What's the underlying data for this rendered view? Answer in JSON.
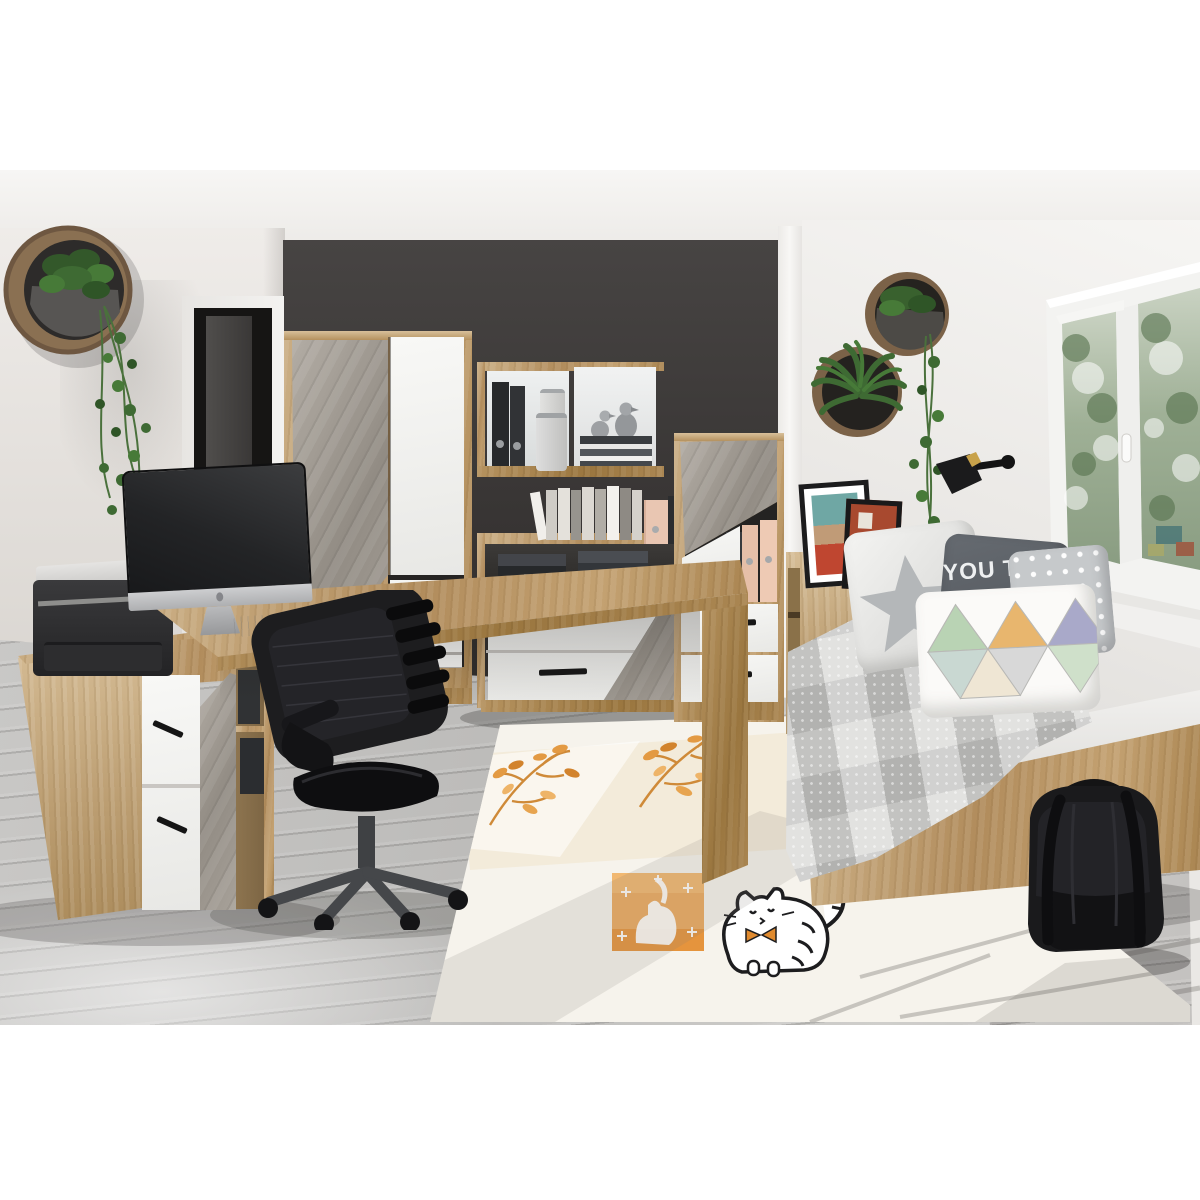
{
  "scene": {
    "title": "Teen room furniture set product photo",
    "pillow_quote": {
      "line1": "YOU T",
      "line2": "MOO",
      "line3": "O BACK"
    },
    "objects": [
      "round wall planter with trailing vine",
      "interior door",
      "wardrobe with concrete and white doors",
      "wall shelf with binders, canisters, books and silver figurines",
      "sideboard with storage boxes",
      "narrow cabinet with pink folders",
      "corner desk",
      "all-in-one computer",
      "keyboard",
      "mouse",
      "laser printer",
      "mesh office chair",
      "low cabinet with drawers and binder shelf",
      "daybed with patchwork quilt",
      "star pillow",
      "quote pillow",
      "polka-dot pillow",
      "triangle pillow",
      "headboard shelf with two picture frames",
      "two round wall planters",
      "black wall lamp",
      "white window with greenery outside",
      "black backpack",
      "kids rug with orange branches and cat print"
    ]
  },
  "palette": {
    "accent_wall": "#3b3837",
    "side_wall": "#e9e7e4",
    "floor_grey": "#c6c5c2",
    "oak": "#c2a070",
    "concrete_grey": "#a29c94",
    "matt_white": "#f5f5f3",
    "rug_cream": "#f6f3ec",
    "rug_orange": "#e5973f",
    "plant_green": "#3e6a33",
    "chair_black": "#1d1d1f"
  }
}
